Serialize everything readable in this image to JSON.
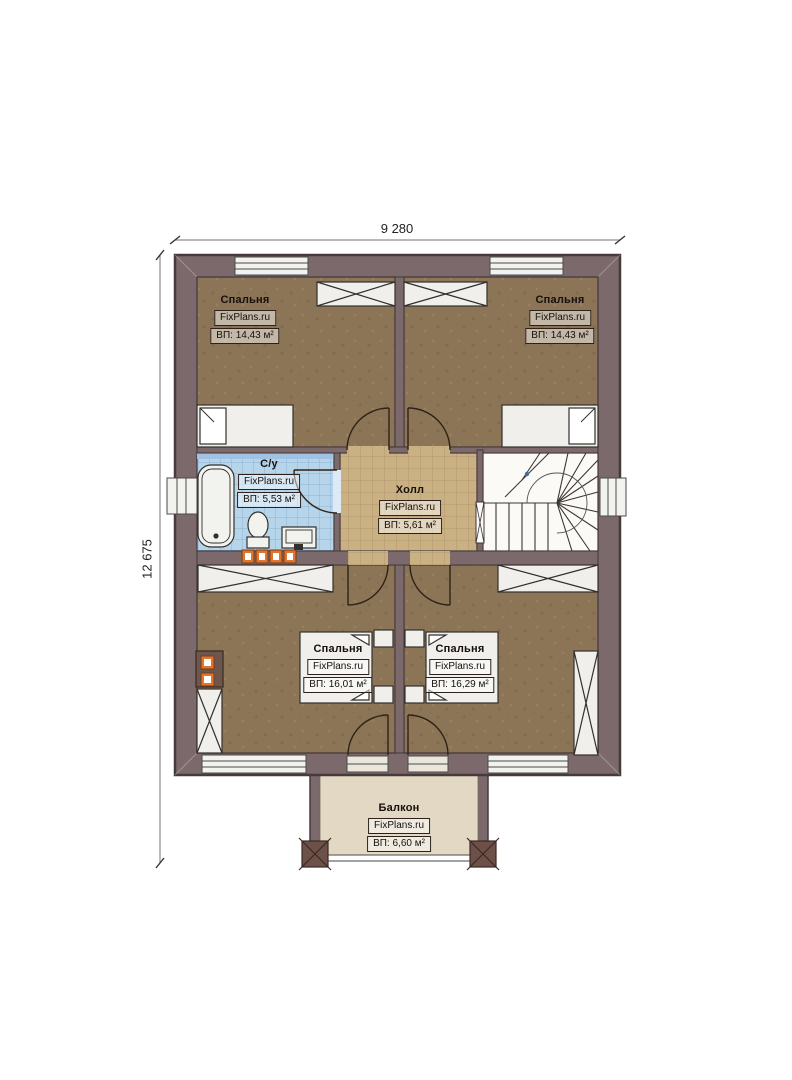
{
  "plan": {
    "dimensions": {
      "width": "9 280",
      "height": "12 675"
    },
    "watermark": "FixPlans.ru",
    "rooms": {
      "bedroom_top_left": {
        "name": "Спальня",
        "area": "ВП: 14,43 м²"
      },
      "bedroom_top_right": {
        "name": "Спальня",
        "area": "ВП: 14,43 м²"
      },
      "bathroom": {
        "name": "С/у",
        "area": "ВП: 5,53 м²"
      },
      "hall": {
        "name": "Холл",
        "area": "ВП: 5,61 м²"
      },
      "bedroom_bottom_left": {
        "name": "Спальня",
        "area": "ВП: 16,01 м²"
      },
      "bedroom_bottom_right": {
        "name": "Спальня",
        "area": "ВП: 16,29 м²"
      },
      "balcony": {
        "name": "Балкон",
        "area": "ВП: 6,60 м²"
      }
    },
    "colors": {
      "wall": "#7c696b",
      "bedroom_floor": "#8c7556",
      "bathroom_tile": "#b7d5ea",
      "hall_tile": "#cab184",
      "balcony_floor": "#e2d8c3",
      "accent_orange": "#e0752f"
    }
  }
}
